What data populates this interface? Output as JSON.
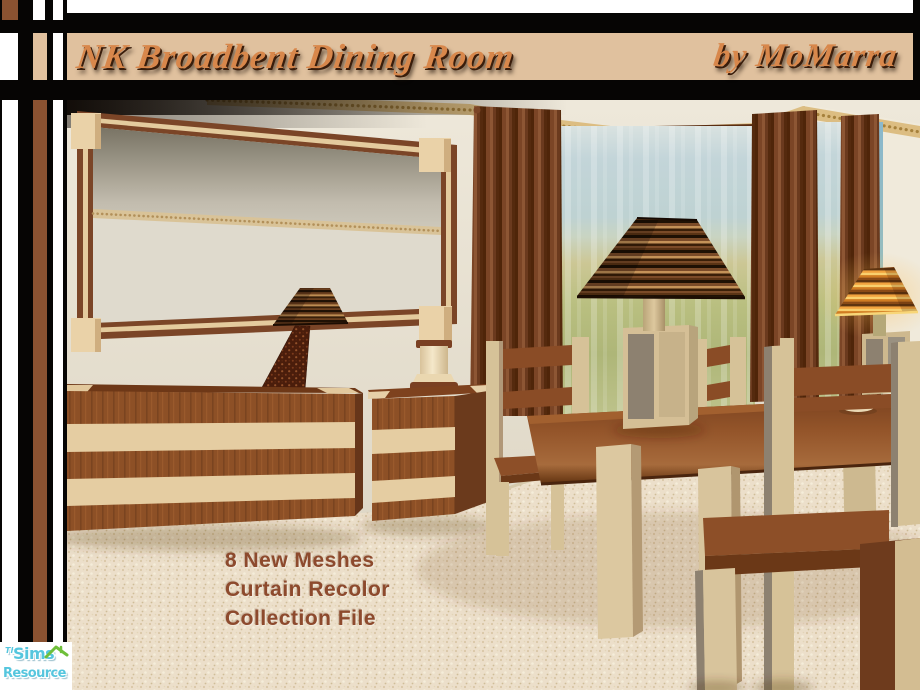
{
  "frame": {
    "title": "NK Broadbent Dining Room",
    "byline": "by MoMarra"
  },
  "overlay": {
    "lines": [
      "8 New Meshes",
      "Curtain Recolor",
      "Collection File"
    ]
  },
  "logo": {
    "the": "The",
    "sims": "Sims",
    "resource": "Resource"
  },
  "colors": {
    "border_black": "#060504",
    "border_brown": "#8a5231",
    "border_tan": "#e0c19e",
    "border_white": "#ffffff",
    "title_text": "#d8874b",
    "overlay_text": "#8d4a2d",
    "logo_cyan": "#55c6de",
    "logo_green": "#6fbf3a",
    "wall_cream": "#e9e3d4",
    "curtain_brown": "#6b3a1e",
    "wood_brown": "#8d5026",
    "wood_tan": "#e5cda2",
    "carpet_cream": "#ecdfca"
  },
  "scene": {
    "items": [
      "wall-mirror",
      "sideboard",
      "mosaic-table-lamp",
      "column-stand",
      "end-table",
      "drape-curtains",
      "sheer-window",
      "dining-table",
      "dining-chairs",
      "striped-pedestal-lamp",
      "lit-accent-lamp",
      "carpet-floor"
    ]
  }
}
